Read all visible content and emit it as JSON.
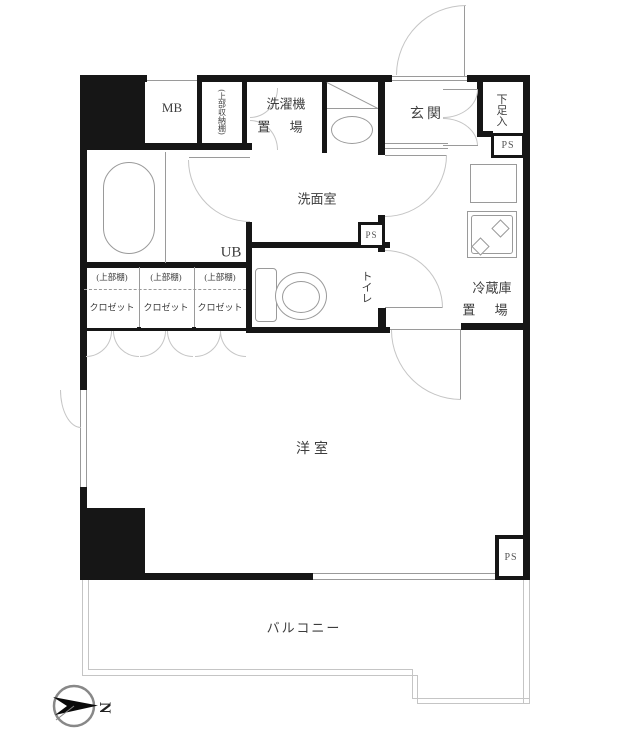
{
  "plan": {
    "labels": {
      "mb": "MB",
      "upper_storage_cabinet": "(上部収納棚)",
      "laundry_line1": "洗濯機",
      "laundry_line2": "置 場",
      "entrance": "玄関",
      "shoe_box": "下足入",
      "washroom": "洗面室",
      "unit_bath": "UB",
      "toilet": "トイレ",
      "fridge_line1": "冷蔵庫",
      "fridge_line2": "置 場",
      "western_room": "洋室",
      "balcony": "バルコニー"
    },
    "closets": [
      {
        "shelf": "(上部棚)",
        "label": "クロゼット"
      },
      {
        "shelf": "(上部棚)",
        "label": "クロゼット"
      },
      {
        "shelf": "(上部棚)",
        "label": "クロゼット"
      }
    ],
    "pipe_spaces": [
      "PS",
      "PS",
      "PS"
    ],
    "compass": {
      "letter": "N"
    },
    "colors": {
      "wall": "#161616",
      "thin_line": "#9a9a9a",
      "arc": "#c5c5c5",
      "text": "#3d3d3d",
      "background": "#ffffff"
    }
  }
}
